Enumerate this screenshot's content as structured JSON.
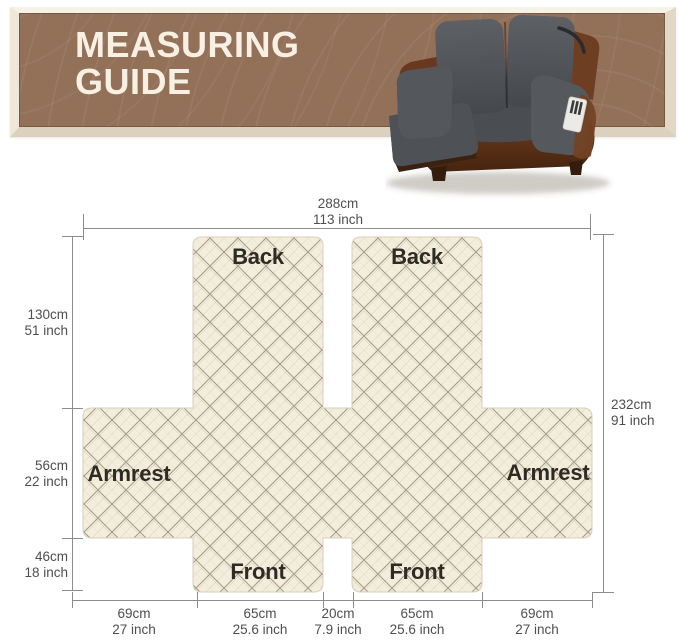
{
  "header": {
    "line1": "MEASURING",
    "line2": "GUIDE"
  },
  "icons": {
    "product_photo": "recliner-loveseat-with-quilted-cover"
  },
  "diagram": {
    "piece_labels": {
      "back_left": "Back",
      "back_right": "Back",
      "armrest_left": "Armrest",
      "armrest_right": "Armrest",
      "front_left": "Front",
      "front_right": "Front"
    },
    "measurements": {
      "top": {
        "cm": "288cm",
        "inch": "113 inch"
      },
      "right": {
        "cm": "232cm",
        "inch": "91 inch"
      },
      "left": [
        {
          "cm": "130cm",
          "inch": "51 inch"
        },
        {
          "cm": "56cm",
          "inch": "22 inch"
        },
        {
          "cm": "46cm",
          "inch": "18 inch"
        }
      ],
      "bottom": [
        {
          "cm": "69cm",
          "inch": "27 inch"
        },
        {
          "cm": "65cm",
          "inch": "25.6 inch"
        },
        {
          "cm": "20cm",
          "inch": "7.9 inch"
        },
        {
          "cm": "65cm",
          "inch": "25.6 inch"
        },
        {
          "cm": "69cm",
          "inch": "27 inch"
        }
      ]
    }
  },
  "colors": {
    "banner_brown": "#937058",
    "banner_frame": "#EFE8D9",
    "banner_text": "#F7F0E3",
    "fabric_cream": "#F3EDDB",
    "fabric_line": "#A29985",
    "measure_text": "#4E4E4E",
    "piece_label_text": "#2E2A24",
    "cover_gray": "#53565A",
    "leather_brown": "#6E3F22"
  }
}
